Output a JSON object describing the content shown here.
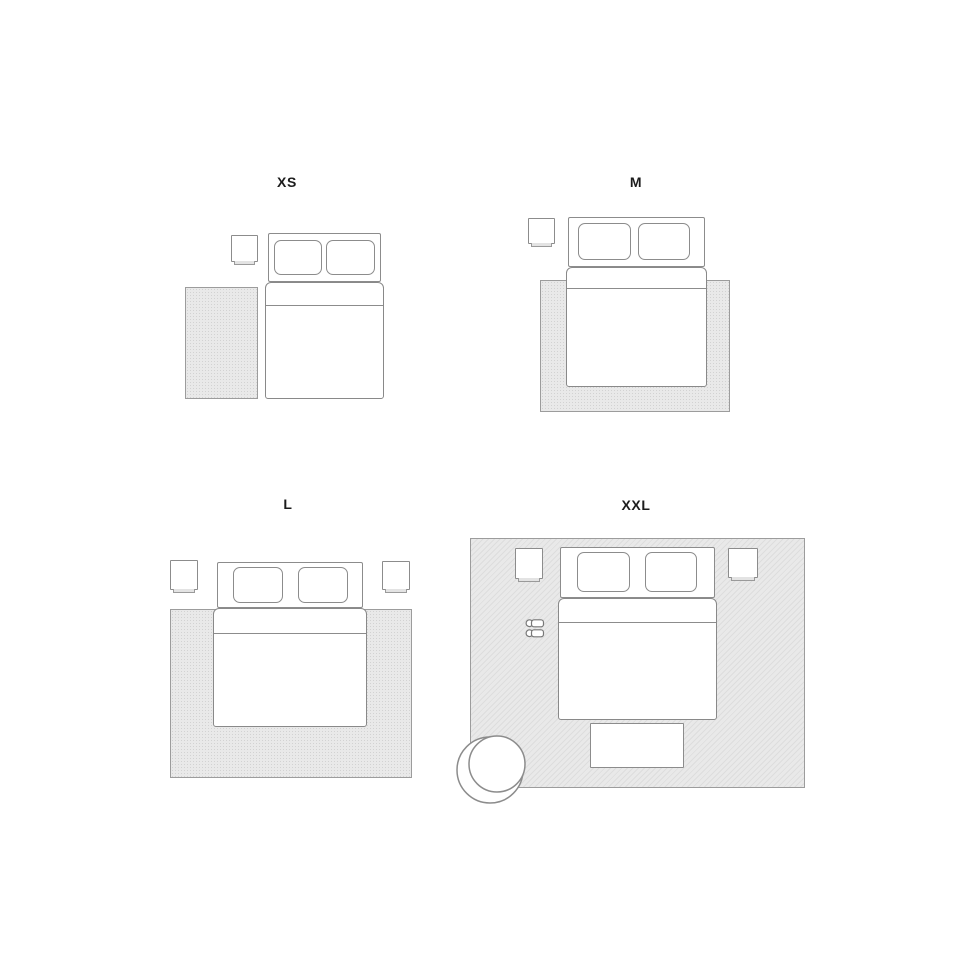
{
  "size_labels": {
    "xs": "XS",
    "m": "M",
    "l": "L",
    "xxl": "XXL"
  },
  "colors": {
    "background": "#ffffff",
    "outline": "#8c8c8c",
    "rug_fill": "#e9e9e9",
    "rug_texture": "#d2d2d2",
    "furniture_fill": "#ffffff",
    "label_text": "#1c1c1c"
  },
  "icons": {
    "bed": "double-bed-top-view",
    "nightstand": "nightstand-top-view",
    "rug": "rug-rectangle",
    "bench": "foot-bench-top-view",
    "armchair": "round-armchair-top-view",
    "slippers": "slippers-pair-top-view"
  }
}
